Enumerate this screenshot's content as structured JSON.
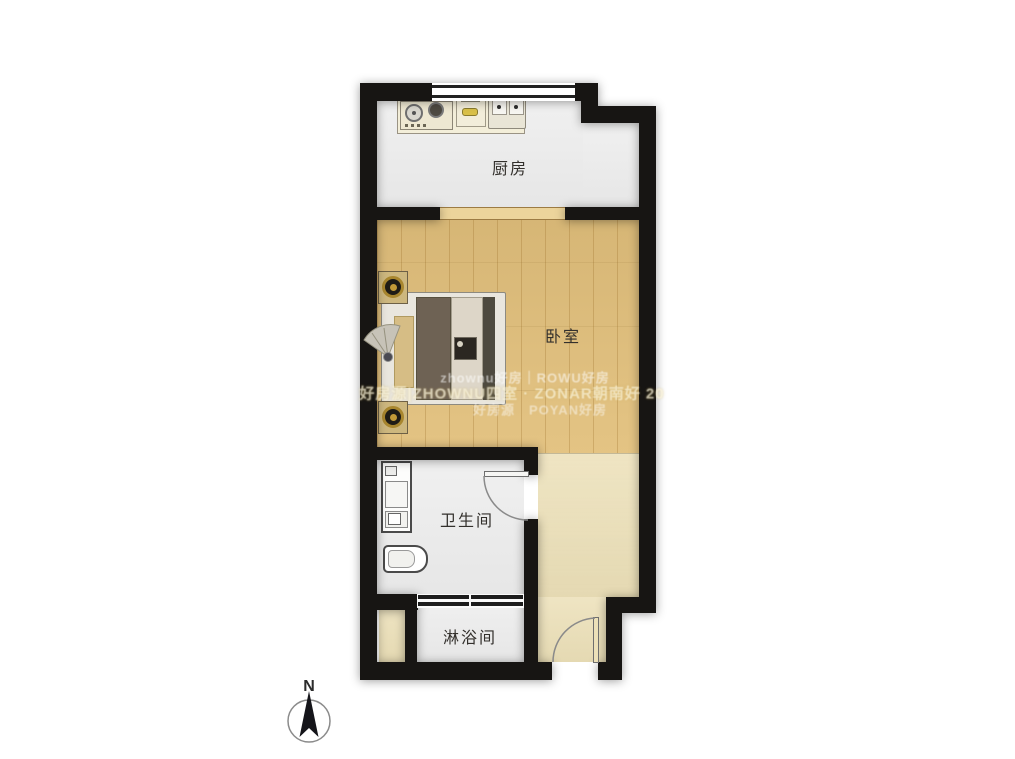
{
  "rooms": {
    "kitchen": {
      "label": "厨房"
    },
    "bedroom": {
      "label": "卧室"
    },
    "bathroom": {
      "label": "卫生间"
    },
    "shower": {
      "label": "淋浴间"
    }
  },
  "compass": {
    "label": "N"
  },
  "watermark": {
    "line1": "zhownu好房｜ROWU好房",
    "line2": "好房源|ZHOWNU四室 · ZONAR朝南好 20",
    "line3": "好房源　POYAN好房"
  },
  "colors": {
    "wall": "#171513",
    "tile": "#ebebeb",
    "wood": "#e2c07c",
    "entry": "#ece0b8",
    "counter": "#f3eed9",
    "accent_gold": "#a8862e"
  }
}
